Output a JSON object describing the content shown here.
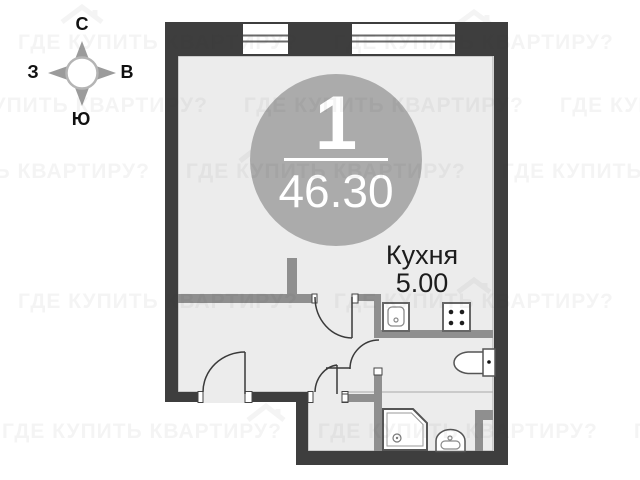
{
  "plan": {
    "badge": {
      "unit_number": "1",
      "area": "46.30"
    },
    "room_labels": [
      {
        "name": "Кухня",
        "area": "5.00"
      }
    ],
    "compass": {
      "north": "С",
      "west": "З",
      "east": "В",
      "south": "Ю"
    },
    "watermark": {
      "text": "ГДЕ КУПИТЬ КВАРТИРУ?"
    },
    "fixtures": [
      "kitchen-sink",
      "stove-4-burner",
      "toilet",
      "shower-cabin",
      "washbasin"
    ],
    "colors": {
      "exterior_wall": "#3e3e3e",
      "partition_wall": "#8f8f8f",
      "floor": "#ececec",
      "badge_circle": "#ababab",
      "label_text": "#1c1c1c"
    }
  }
}
